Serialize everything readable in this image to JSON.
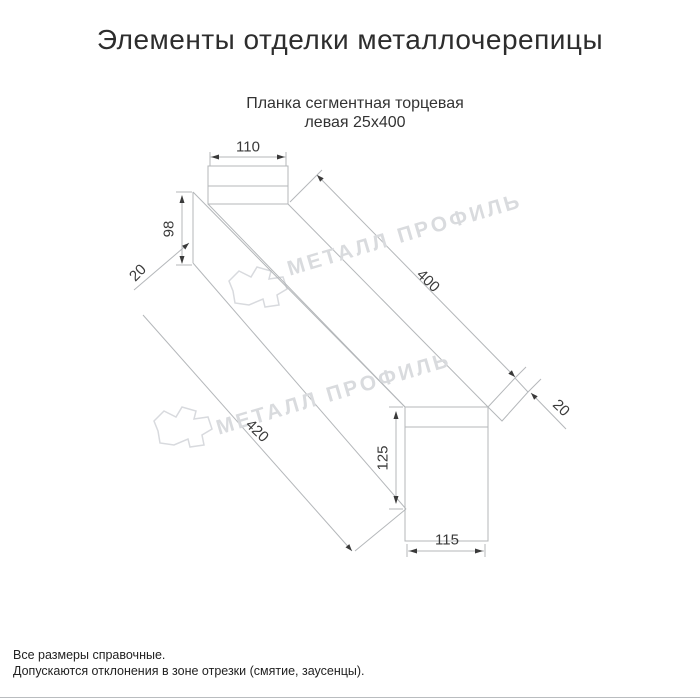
{
  "page": {
    "title": "Элементы отделки металлочерепицы",
    "background_color": "#ffffff",
    "accent_text_color": "#2d2d2d"
  },
  "drawing": {
    "subtitle_line1": "Планка сегментная торцевая",
    "subtitle_line2": "левая 25х400",
    "type": "isometric technical drawing of left segment end trim strip",
    "line_color": "#b4b7ba",
    "dimension_text_color": "#3a3a3a",
    "dimensions": [
      {
        "id": "dim-110",
        "value": "110",
        "orientation": "horizontal"
      },
      {
        "id": "dim-98",
        "value": "98",
        "orientation": "vertical"
      },
      {
        "id": "dim-20-top",
        "value": "20",
        "orientation": "diagonal-up"
      },
      {
        "id": "dim-400",
        "value": "400",
        "orientation": "diagonal-down"
      },
      {
        "id": "dim-20-bottom",
        "value": "20",
        "orientation": "diagonal-down"
      },
      {
        "id": "dim-420",
        "value": "420",
        "orientation": "diagonal-down"
      },
      {
        "id": "dim-125",
        "value": "125",
        "orientation": "vertical"
      },
      {
        "id": "dim-115",
        "value": "115",
        "orientation": "horizontal"
      }
    ]
  },
  "watermark": {
    "text": "МЕТАЛЛ ПРОФИЛЬ",
    "color": "#d9dbde",
    "instances": 2
  },
  "footer": {
    "line1": "Все размеры справочные.",
    "line2": "Допускаются отклонения в зоне отрезки (смятие, заусенцы)."
  }
}
